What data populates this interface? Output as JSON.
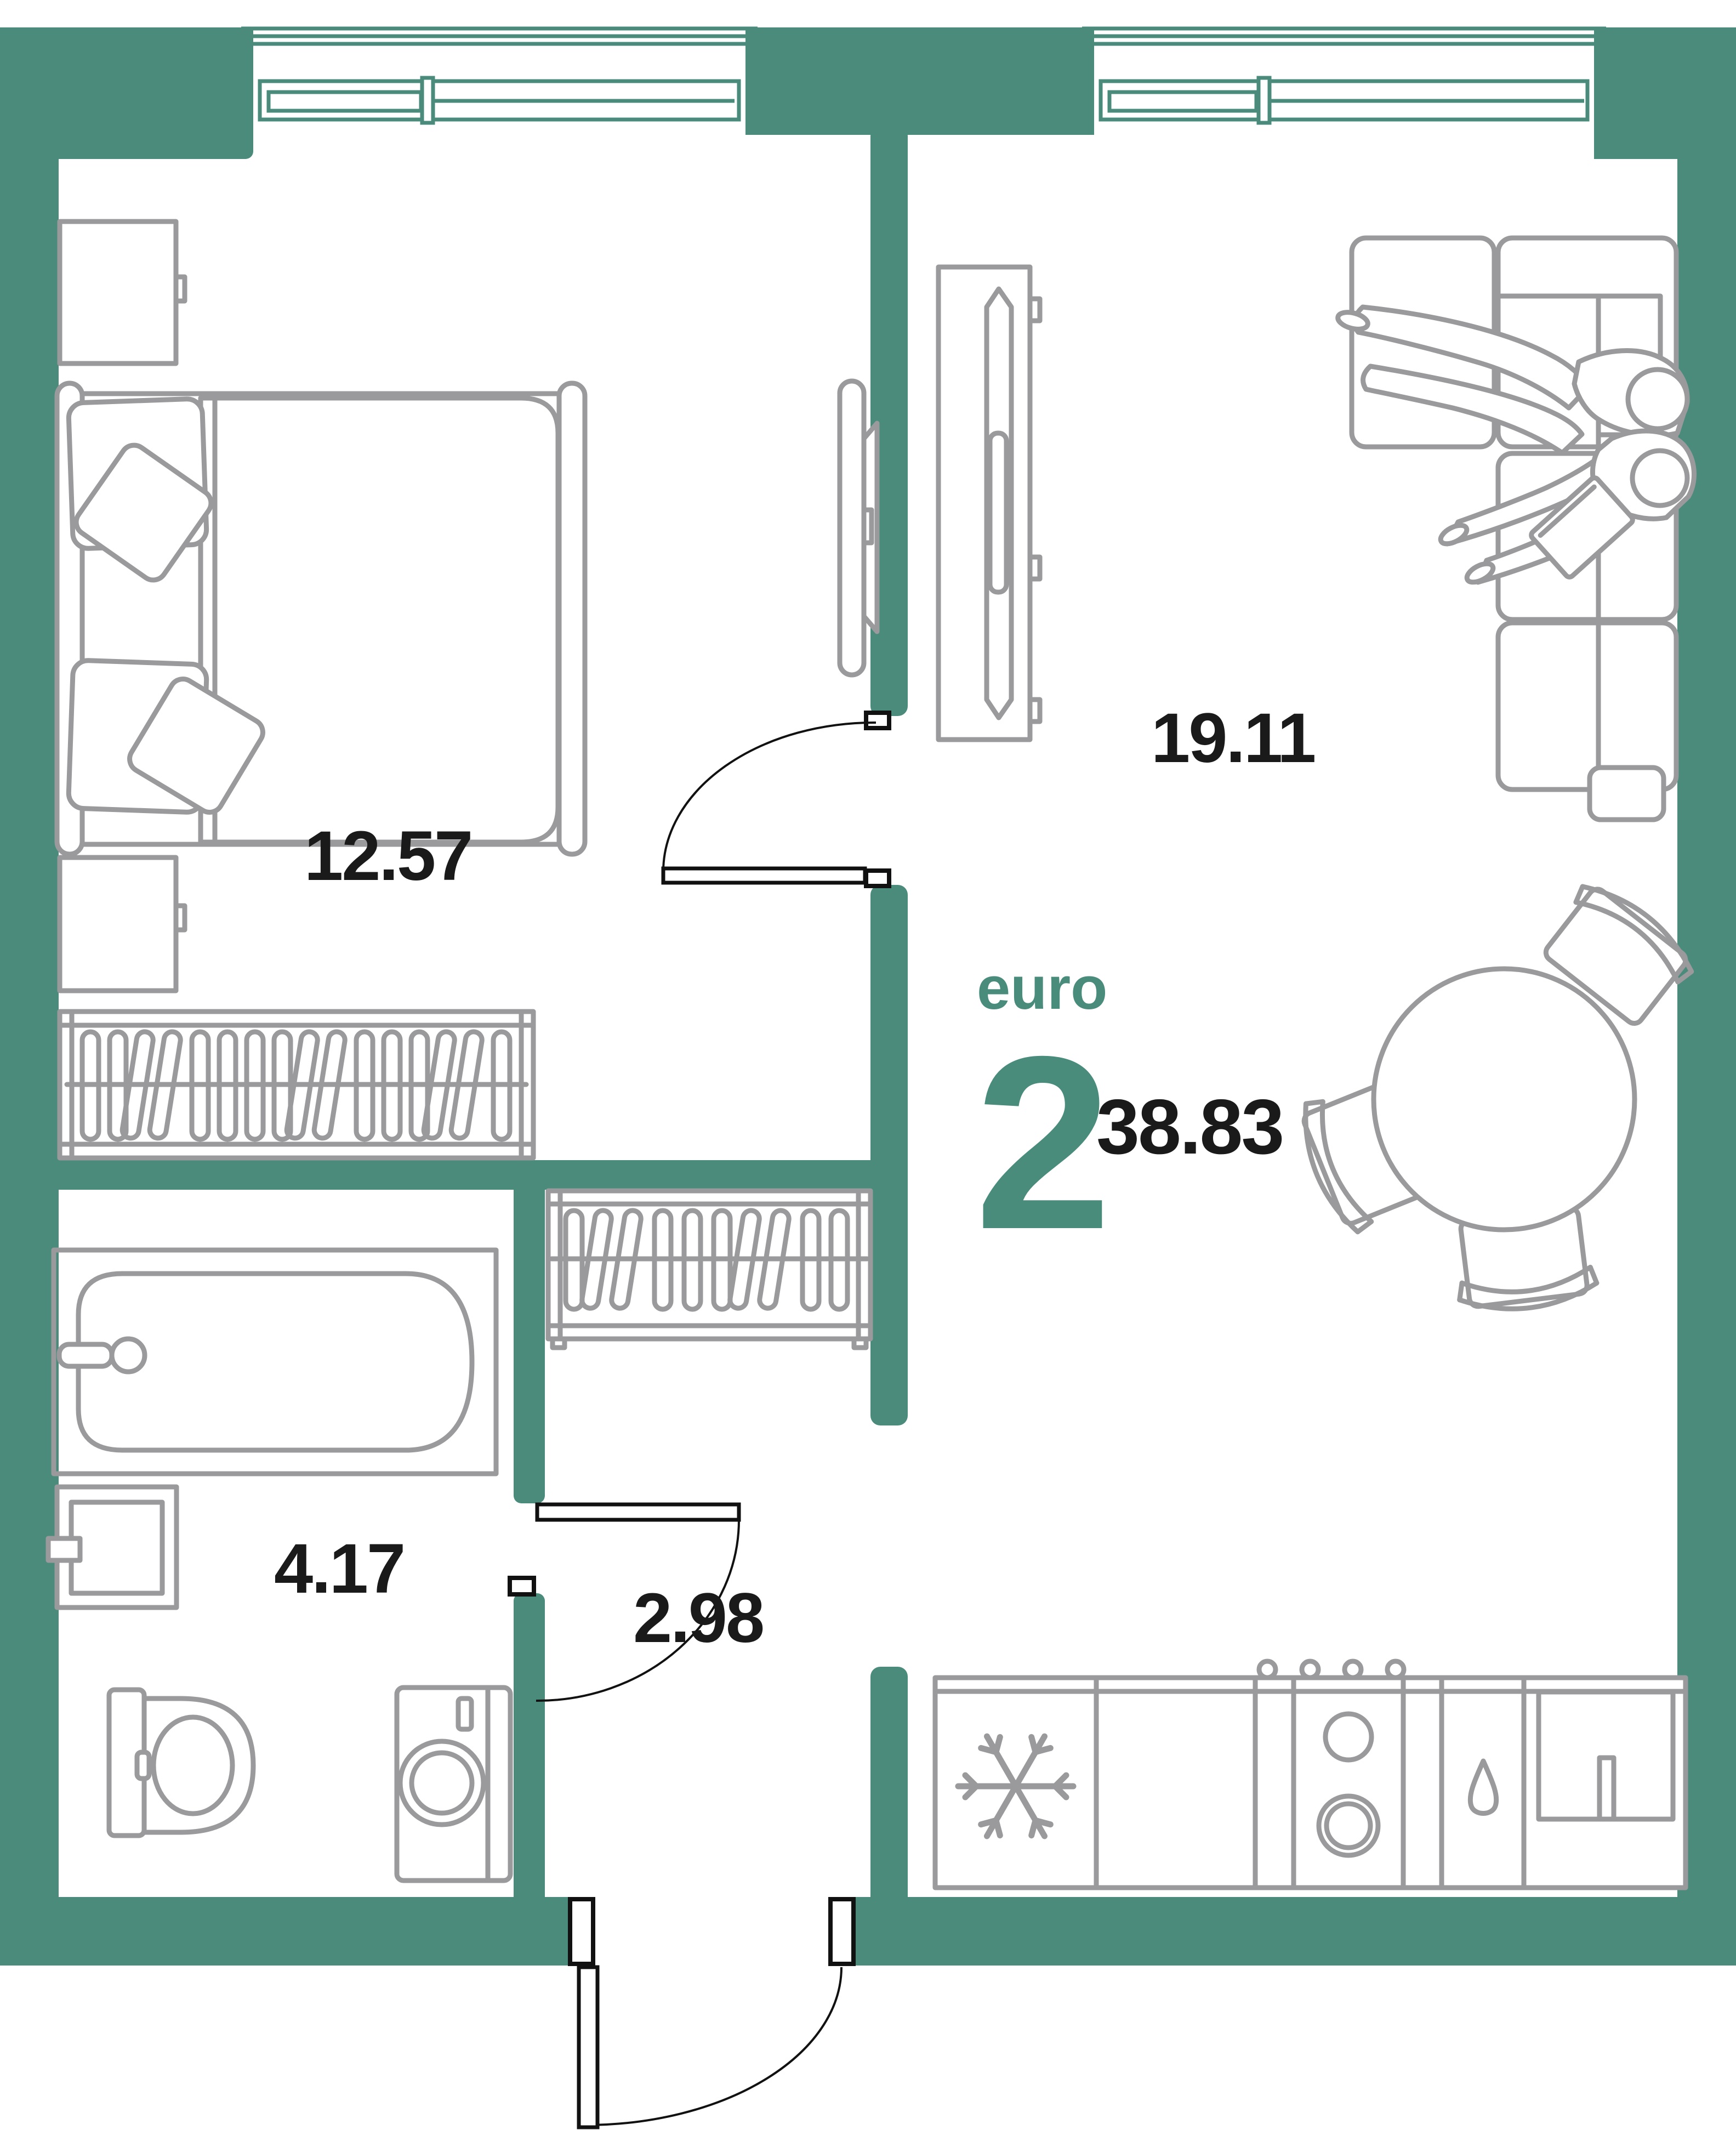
{
  "plan": {
    "type": "apartment-floor-plan",
    "title": {
      "prefix": "euro",
      "rooms_count": "2",
      "total_area": "38.83"
    },
    "rooms": [
      {
        "id": "bedroom",
        "area": "12.57"
      },
      {
        "id": "living-kitchen",
        "area": "19.11"
      },
      {
        "id": "bathroom",
        "area": "4.17"
      },
      {
        "id": "hallway",
        "area": "2.98"
      }
    ],
    "colors": {
      "walls": "#4A8B7B",
      "accent_text": "#4A8C7C",
      "furniture_outline": "#9A9A9C",
      "door_lines": "#111111",
      "room_labels": "#1A1A1A",
      "background": "#FFFFFF"
    },
    "icons": [
      "window",
      "door-swing",
      "bed",
      "pillow",
      "nightstand",
      "wardrobe-hangers",
      "tv",
      "tv-console",
      "sofa",
      "person",
      "laptop",
      "dining-table",
      "chair",
      "bathtub",
      "faucet",
      "washbasin",
      "toilet",
      "washing-machine",
      "fridge-snowflake",
      "stove-burners",
      "knob",
      "kitchen-sink",
      "water-drop"
    ]
  }
}
